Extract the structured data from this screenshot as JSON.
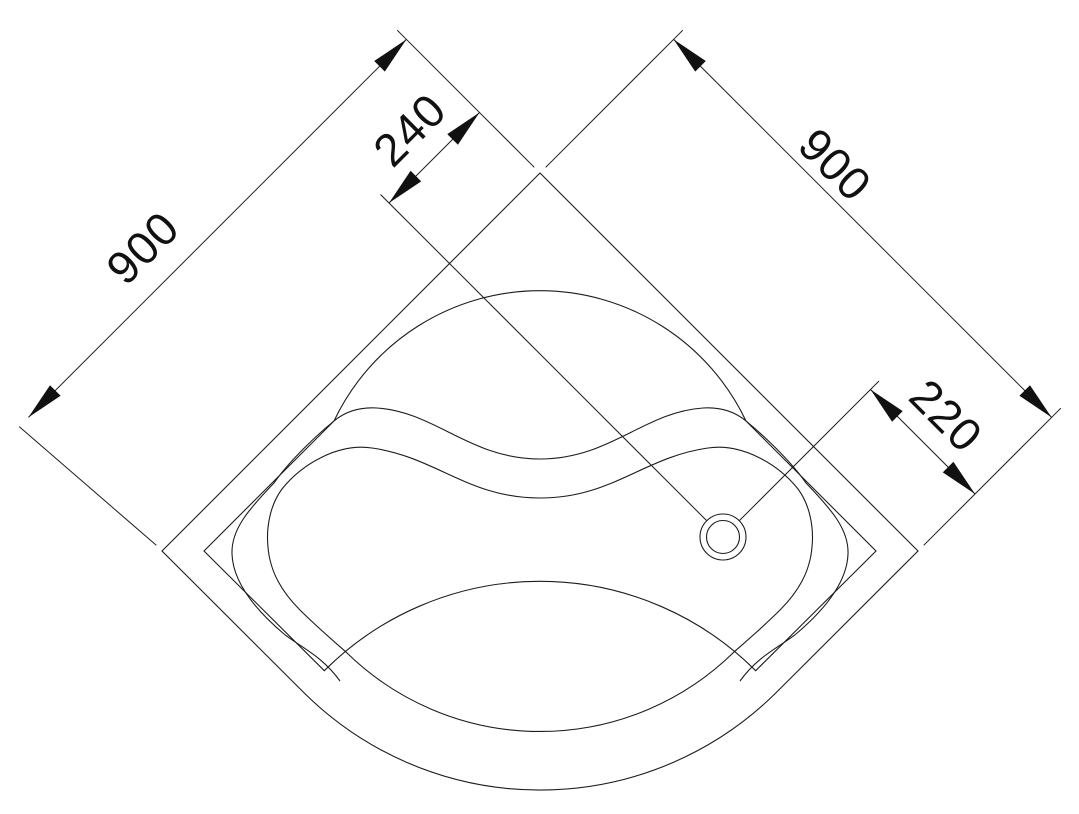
{
  "drawing": {
    "kind": "technical plan view",
    "subject": "quadrant corner shower tray with drain",
    "background_color": "#ffffff",
    "line_color": "#1c1c1c",
    "text_color": "#111111"
  },
  "dimensions": {
    "left_edge": {
      "label": "900"
    },
    "right_edge": {
      "label": "900"
    },
    "drain_offset_back": {
      "label": "240"
    },
    "drain_offset_corner": {
      "label": "220"
    }
  }
}
